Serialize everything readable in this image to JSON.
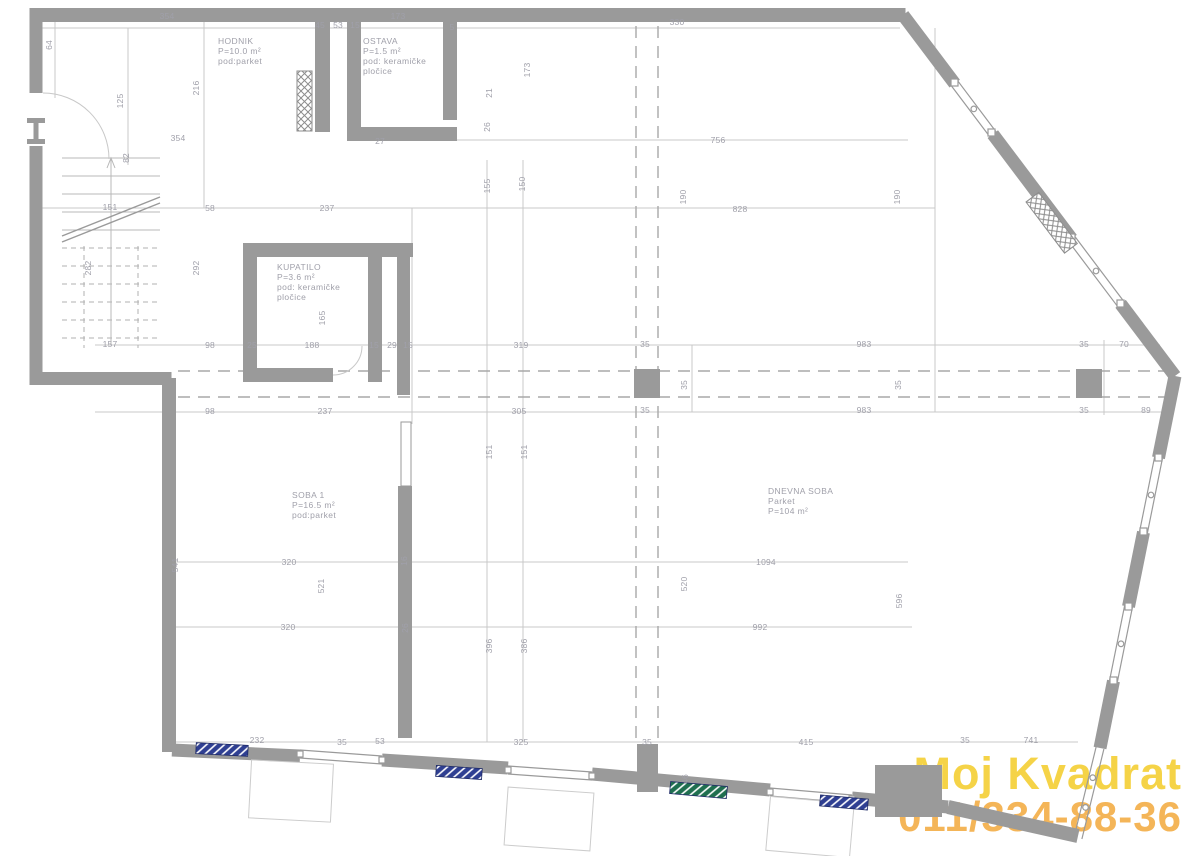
{
  "colors": {
    "wall": "#9a9a9a",
    "line": "#c6c6c6",
    "dash": "#a8a8a8",
    "text": "#a0a0aa",
    "wm1": "#f4cc27",
    "wm2": "#f3a93c",
    "hatchblue": "#2f3f92",
    "hatchgreen": "#1f6f4f"
  },
  "watermark": {
    "line1": "Moj Kvadrat",
    "line2": "011/334-88-36"
  },
  "rooms": [
    {
      "name": "hodnik",
      "x": 218,
      "y": 36,
      "lines": [
        "HODNIK",
        "P=10.0 m²",
        "pod:parket"
      ]
    },
    {
      "name": "ostava",
      "x": 363,
      "y": 36,
      "lines": [
        "OSTAVA",
        "P=1.5 m²",
        "pod: keramičke",
        "pločice"
      ]
    },
    {
      "name": "kupatilo",
      "x": 277,
      "y": 262,
      "lines": [
        "KUPATILO",
        "P=3.6 m²",
        "pod: keramičke",
        "pločice"
      ]
    },
    {
      "name": "soba-1",
      "x": 292,
      "y": 490,
      "lines": [
        "SOBA 1",
        "P=16.5 m²",
        "pod:parket"
      ]
    },
    {
      "name": "dnevna-soba",
      "x": 768,
      "y": 486,
      "lines": [
        "DNEVNA SOBA",
        "Parket",
        "P=104 m²"
      ]
    }
  ],
  "dimensions": [
    {
      "t": "354",
      "x": 167,
      "y": 16
    },
    {
      "t": "45",
      "x": 320,
      "y": 25
    },
    {
      "t": "53",
      "x": 338,
      "y": 25
    },
    {
      "t": "15",
      "x": 355,
      "y": 25
    },
    {
      "t": "173",
      "x": 398,
      "y": 16
    },
    {
      "t": "5",
      "x": 452,
      "y": 27
    },
    {
      "t": "330",
      "x": 677,
      "y": 22
    },
    {
      "t": "64",
      "x": 49,
      "y": 45,
      "r": 1
    },
    {
      "t": "216",
      "x": 196,
      "y": 88,
      "r": 1
    },
    {
      "t": "125",
      "x": 120,
      "y": 101,
      "r": 1
    },
    {
      "t": "354",
      "x": 178,
      "y": 138
    },
    {
      "t": "27",
      "x": 380,
      "y": 141
    },
    {
      "t": "82",
      "x": 126,
      "y": 158,
      "r": 1
    },
    {
      "t": "173",
      "x": 527,
      "y": 70,
      "r": 1
    },
    {
      "t": "21",
      "x": 489,
      "y": 93,
      "r": 1
    },
    {
      "t": "26",
      "x": 487,
      "y": 127,
      "r": 1
    },
    {
      "t": "756",
      "x": 718,
      "y": 140
    },
    {
      "t": "151",
      "x": 110,
      "y": 207
    },
    {
      "t": "58",
      "x": 210,
      "y": 208
    },
    {
      "t": "237",
      "x": 327,
      "y": 208
    },
    {
      "t": "155",
      "x": 487,
      "y": 186,
      "r": 1
    },
    {
      "t": "150",
      "x": 522,
      "y": 184,
      "r": 1
    },
    {
      "t": "190",
      "x": 683,
      "y": 197,
      "r": 1
    },
    {
      "t": "828",
      "x": 740,
      "y": 209
    },
    {
      "t": "190",
      "x": 897,
      "y": 197,
      "r": 1
    },
    {
      "t": "282",
      "x": 88,
      "y": 268,
      "r": 1
    },
    {
      "t": "292",
      "x": 196,
      "y": 268,
      "r": 1
    },
    {
      "t": "165",
      "x": 322,
      "y": 318,
      "r": 1
    },
    {
      "t": "157",
      "x": 110,
      "y": 344
    },
    {
      "t": "98",
      "x": 210,
      "y": 345
    },
    {
      "t": "25",
      "x": 252,
      "y": 345
    },
    {
      "t": "188",
      "x": 312,
      "y": 345
    },
    {
      "t": "15",
      "x": 374,
      "y": 345
    },
    {
      "t": "29",
      "x": 392,
      "y": 345
    },
    {
      "t": "15",
      "x": 408,
      "y": 345
    },
    {
      "t": "319",
      "x": 521,
      "y": 345
    },
    {
      "t": "35",
      "x": 645,
      "y": 344
    },
    {
      "t": "983",
      "x": 864,
      "y": 344
    },
    {
      "t": "35",
      "x": 1084,
      "y": 344
    },
    {
      "t": "70",
      "x": 1124,
      "y": 344
    },
    {
      "t": "35",
      "x": 684,
      "y": 385,
      "r": 1
    },
    {
      "t": "35",
      "x": 898,
      "y": 385,
      "r": 1
    },
    {
      "t": "98",
      "x": 210,
      "y": 411
    },
    {
      "t": "237",
      "x": 325,
      "y": 411
    },
    {
      "t": "305",
      "x": 519,
      "y": 411
    },
    {
      "t": "35",
      "x": 645,
      "y": 410
    },
    {
      "t": "983",
      "x": 864,
      "y": 410
    },
    {
      "t": "35",
      "x": 1084,
      "y": 410
    },
    {
      "t": "89",
      "x": 1146,
      "y": 410
    },
    {
      "t": "151",
      "x": 489,
      "y": 452,
      "r": 1
    },
    {
      "t": "151",
      "x": 524,
      "y": 452,
      "r": 1
    },
    {
      "t": "541",
      "x": 175,
      "y": 565,
      "r": 1
    },
    {
      "t": "320",
      "x": 289,
      "y": 562
    },
    {
      "t": "521",
      "x": 321,
      "y": 586,
      "r": 1
    },
    {
      "t": "16",
      "x": 404,
      "y": 561,
      "r": 1
    },
    {
      "t": "320",
      "x": 288,
      "y": 627
    },
    {
      "t": "26",
      "x": 405,
      "y": 628,
      "r": 1
    },
    {
      "t": "396",
      "x": 489,
      "y": 646,
      "r": 1
    },
    {
      "t": "386",
      "x": 524,
      "y": 646,
      "r": 1
    },
    {
      "t": "520",
      "x": 684,
      "y": 584,
      "r": 1
    },
    {
      "t": "1094",
      "x": 766,
      "y": 562
    },
    {
      "t": "992",
      "x": 760,
      "y": 627
    },
    {
      "t": "596",
      "x": 899,
      "y": 601,
      "r": 1
    },
    {
      "t": "232",
      "x": 257,
      "y": 740
    },
    {
      "t": "35",
      "x": 342,
      "y": 742
    },
    {
      "t": "53",
      "x": 380,
      "y": 741
    },
    {
      "t": "325",
      "x": 521,
      "y": 742
    },
    {
      "t": "35",
      "x": 647,
      "y": 742
    },
    {
      "t": "415",
      "x": 806,
      "y": 742
    },
    {
      "t": "35",
      "x": 965,
      "y": 740
    },
    {
      "t": "741",
      "x": 1031,
      "y": 740
    },
    {
      "t": "46",
      "x": 685,
      "y": 779,
      "r": 1
    }
  ]
}
